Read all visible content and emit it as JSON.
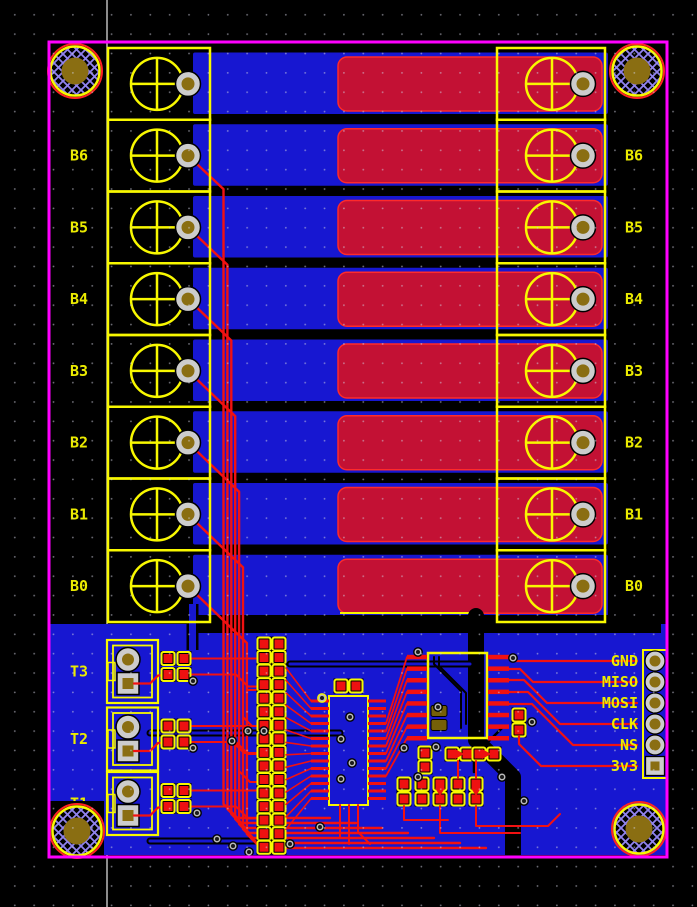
{
  "board": {
    "left_channel_labels": [
      "B6",
      "B5",
      "B4",
      "B3",
      "B2",
      "B1",
      "B0"
    ],
    "right_channel_labels": [
      "B6",
      "B5",
      "B4",
      "B3",
      "B2",
      "B1",
      "B0"
    ],
    "terminal_labels": [
      "T3",
      "T2",
      "T1"
    ],
    "spi_header_labels": [
      "GND",
      "MISO",
      "MOSI",
      "CLK",
      "NS",
      "3v3"
    ]
  },
  "colors": {
    "background": "#000000",
    "board_outline": "#ff00ff",
    "bottom_copper": "#1717d1",
    "top_copper_pour": "#c31134",
    "top_copper_trace": "#f21111",
    "smd_pad": "#ee1111",
    "silkscreen": "#f8f800",
    "label_text": "#ebeb00",
    "drill": "#8a6e12",
    "pad_ring": "#cccccc",
    "hole_hatch": "#9183ee",
    "axis_line": "#d8d8d8"
  }
}
